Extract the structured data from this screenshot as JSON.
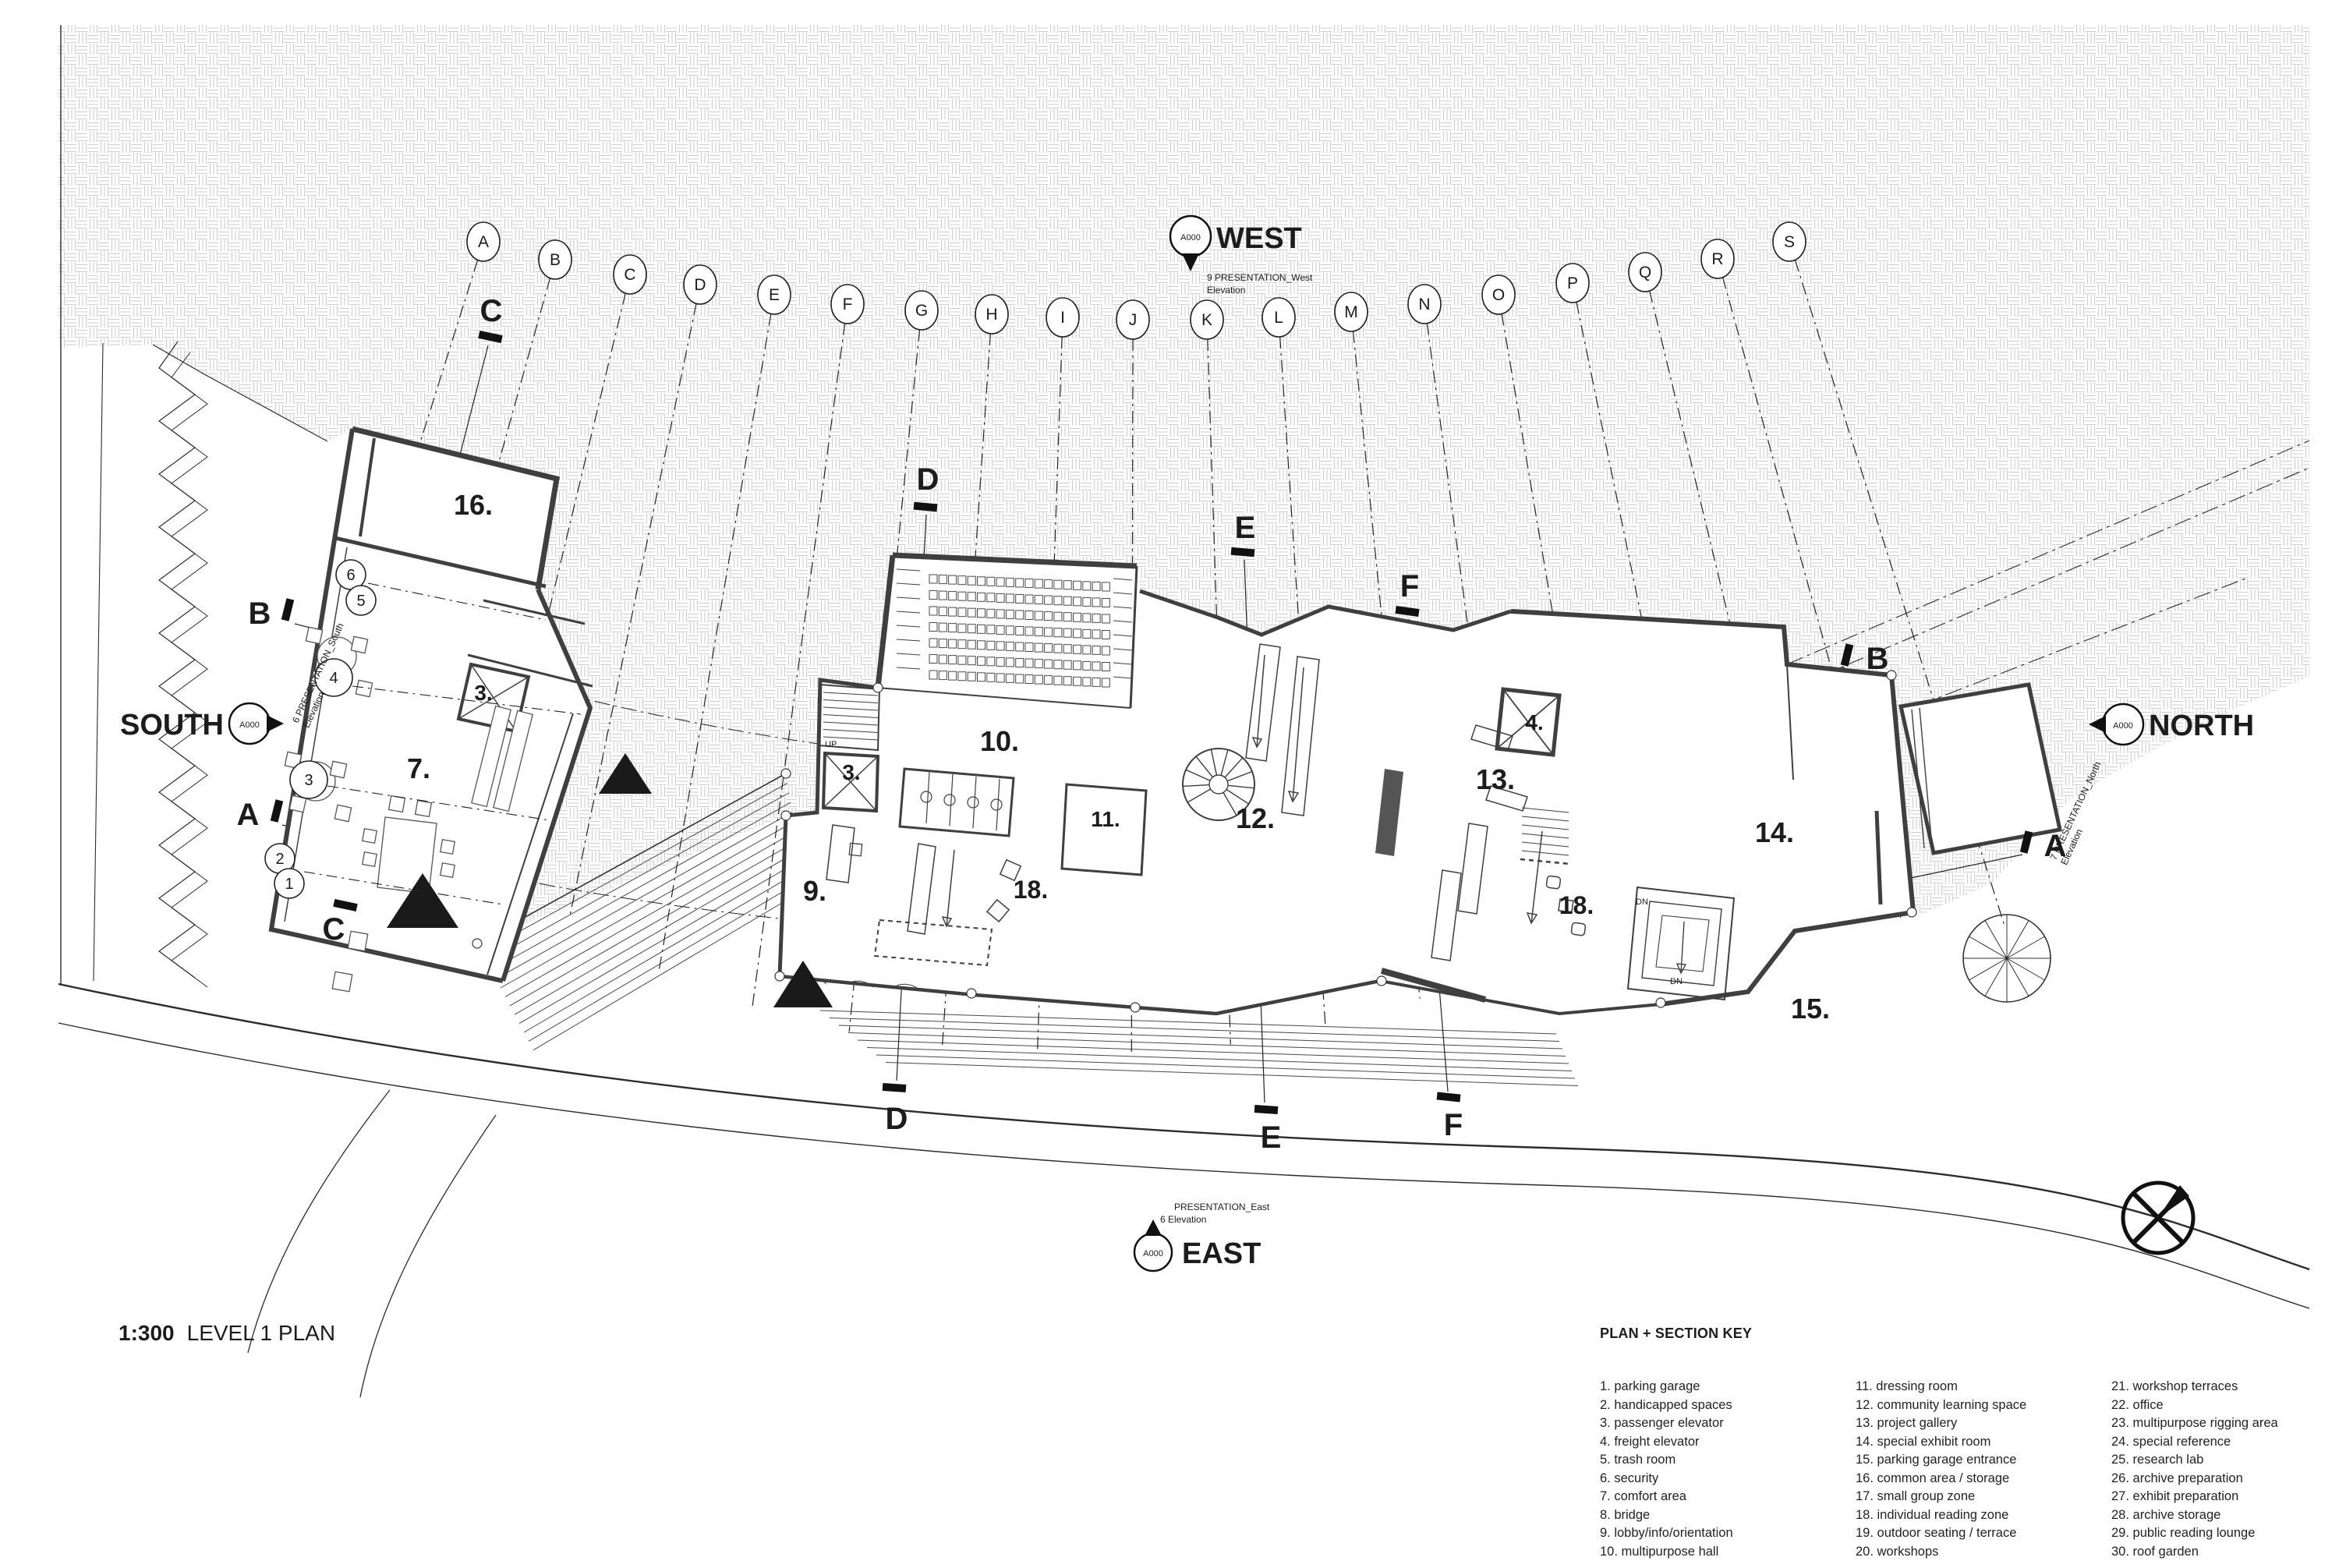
{
  "title": {
    "scale_label": "1:300",
    "plan_label": "LEVEL 1 PLAN"
  },
  "legend": {
    "heading": "PLAN + SECTION KEY",
    "columns": [
      [
        {
          "n": "1",
          "label": "parking garage"
        },
        {
          "n": "2",
          "label": "handicapped spaces"
        },
        {
          "n": "3",
          "label": "passenger elevator"
        },
        {
          "n": "4",
          "label": "freight elevator"
        },
        {
          "n": "5",
          "label": "trash room"
        },
        {
          "n": "6",
          "label": "security"
        },
        {
          "n": "7",
          "label": "comfort area"
        },
        {
          "n": "8",
          "label": "bridge"
        },
        {
          "n": "9",
          "label": "lobby/info/orientation"
        },
        {
          "n": "10",
          "label": "multipurpose hall"
        }
      ],
      [
        {
          "n": "11",
          "label": "dressing room"
        },
        {
          "n": "12",
          "label": "community learning space"
        },
        {
          "n": "13",
          "label": "project gallery"
        },
        {
          "n": "14",
          "label": "special exhibit room"
        },
        {
          "n": "15",
          "label": "parking garage entrance"
        },
        {
          "n": "16",
          "label": "common area / storage"
        },
        {
          "n": "17",
          "label": "small group zone"
        },
        {
          "n": "18",
          "label": "individual reading zone"
        },
        {
          "n": "19",
          "label": "outdoor seating / terrace"
        },
        {
          "n": "20",
          "label": "workshops"
        }
      ],
      [
        {
          "n": "21",
          "label": "workshop terraces"
        },
        {
          "n": "22",
          "label": "office"
        },
        {
          "n": "23",
          "label": "multipurpose rigging area"
        },
        {
          "n": "24",
          "label": "special reference"
        },
        {
          "n": "25",
          "label": "research lab"
        },
        {
          "n": "26",
          "label": "archive preparation"
        },
        {
          "n": "27",
          "label": "exhibit preparation"
        },
        {
          "n": "28",
          "label": "archive storage"
        },
        {
          "n": "29",
          "label": "public reading lounge"
        },
        {
          "n": "30",
          "label": "roof garden"
        }
      ]
    ]
  },
  "compass": {
    "west": {
      "label": "WEST",
      "sheet": "A000",
      "caption1": "9 PRESENTATION_West",
      "caption2": "Elevation"
    },
    "south": {
      "label": "SOUTH",
      "sheet": "A000",
      "caption1": "6 PRESENTATION_South",
      "caption2": "Elevation"
    },
    "north": {
      "label": "NORTH",
      "sheet": "A000",
      "caption1": "7 PRESENTATION_North",
      "caption2": "Elevation"
    },
    "east": {
      "label": "EAST",
      "sheet": "A000",
      "caption1": "PRESENTATION_East",
      "caption2": "6 Elevation"
    }
  },
  "grid": {
    "letters": [
      "A",
      "B",
      "C",
      "D",
      "E",
      "F",
      "G",
      "H",
      "I",
      "J",
      "K",
      "L",
      "M",
      "N",
      "O",
      "P",
      "Q",
      "R",
      "S"
    ],
    "numbers": [
      "6",
      "5",
      "4",
      "3",
      "2",
      "1"
    ]
  },
  "sections": {
    "a": "A",
    "b": "B",
    "c": "C",
    "d": "D",
    "e": "E",
    "f": "F"
  },
  "rooms": [
    "16.",
    "7.",
    "3.",
    "3.",
    "9.",
    "10.",
    "11.",
    "12.",
    "13.",
    "4.",
    "18.",
    "18.",
    "14.",
    "15."
  ],
  "misc": {
    "up": "UP",
    "dn": "DN"
  },
  "colors": {
    "ink": "#1c1c1c",
    "wall": "#3f3f3f",
    "hatch": "#cdcdcd"
  }
}
